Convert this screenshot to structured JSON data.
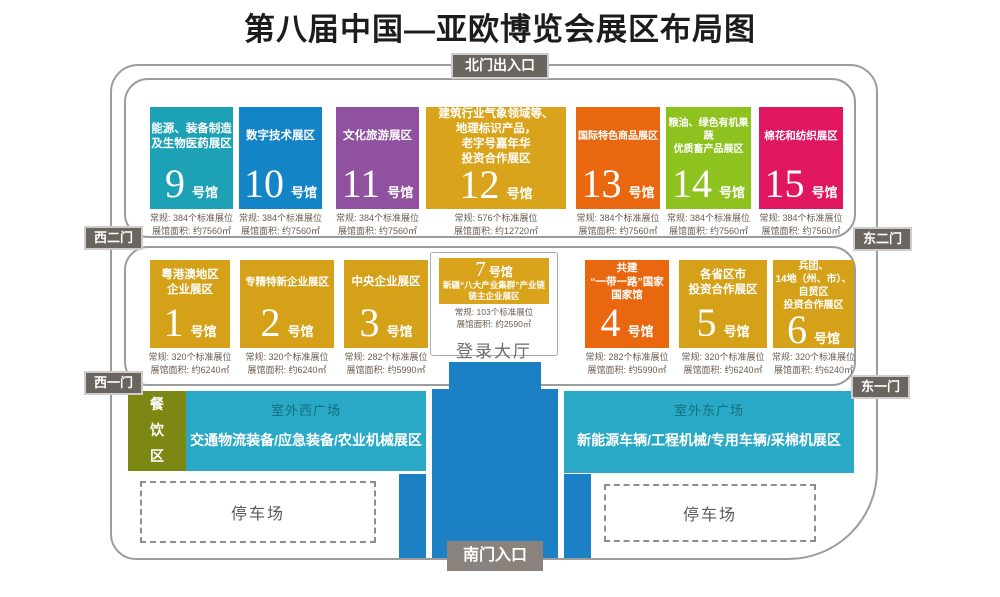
{
  "title": "第八届中国—亚欧博览会展区布局图",
  "gates": {
    "north": "北门出入口",
    "south": "南门入口",
    "west2": "西二门",
    "west1": "西一门",
    "east2": "东二门",
    "east1": "东一门"
  },
  "labels": {
    "hall_suffix": "号馆",
    "login_hall": "登录大厅",
    "dining": "餐饮区",
    "parking": "停车场"
  },
  "halls_row1": [
    {
      "number": "9",
      "name": "能源、装备制造\n及生物医药展区",
      "booths": "常规: 384个标准展位",
      "area": "展馆面积: 约7560㎡",
      "color": "#1ca1b6"
    },
    {
      "number": "10",
      "name": "数字技术展区",
      "booths": "常规: 384个标准展位",
      "area": "展馆面积: 约7560㎡",
      "color": "#1385c6"
    },
    {
      "number": "11",
      "name": "文化旅游展区",
      "booths": "常规: 384个标准展位",
      "area": "展馆面积: 约7560㎡",
      "color": "#9051a0"
    },
    {
      "number": "12",
      "name": "建筑行业气象领域等、\n地理标识产品，\n老字号嘉年华\n投资合作展区",
      "booths": "常规: 576个标准展位",
      "area": "展馆面积: 约12720㎡",
      "color": "#d9a41c"
    },
    {
      "number": "13",
      "name": "国际特色商品展区",
      "booths": "常规: 384个标准展位",
      "area": "展馆面积: 约7560㎡",
      "color": "#e9680f"
    },
    {
      "number": "14",
      "name": "粮油、绿色有机果蔬\n优质畜产品展区",
      "booths": "常规: 384个标准展位",
      "area": "展馆面积: 约7560㎡",
      "color": "#8dc21f"
    },
    {
      "number": "15",
      "name": "棉花和纺织展区",
      "booths": "常规: 384个标准展位",
      "area": "展馆面积: 约7560㎡",
      "color": "#e0175f"
    }
  ],
  "halls_row2": [
    {
      "number": "1",
      "name": "粤港澳地区\n企业展区",
      "booths": "常规: 320个标准展位",
      "area": "展馆面积: 约6240㎡",
      "color": "#d4a119"
    },
    {
      "number": "2",
      "name": "专精特新企业展区",
      "booths": "常规: 320个标准展位",
      "area": "展馆面积: 约6240㎡",
      "color": "#d4a119"
    },
    {
      "number": "3",
      "name": "中央企业展区",
      "booths": "常规: 282个标准展位",
      "area": "展馆面积: 约5990㎡",
      "color": "#d4a119"
    },
    {
      "number": "4",
      "name": "共建\n“一带一路”国家\n国家馆",
      "booths": "常规: 282个标准展位",
      "area": "展馆面积: 约5990㎡",
      "color": "#e9680f"
    },
    {
      "number": "5",
      "name": "各省区市\n投资合作展区",
      "booths": "常规: 320个标准展位",
      "area": "展馆面积: 约6240㎡",
      "color": "#d4a119"
    },
    {
      "number": "6",
      "name": "兵团、\n14地（州、市）、\n自贸区\n投资合作展区",
      "booths": "常规: 320个标准展位",
      "area": "展馆面积: 约6240㎡",
      "color": "#d4a119"
    }
  ],
  "hall7": {
    "number": "7",
    "name": "新疆“八大产业集群”产业链\n链主企业展区",
    "booths": "常规: 103个标准展位",
    "area": "展馆面积: 约2590㎡",
    "color": "#d9a41c"
  },
  "plazas": {
    "west": {
      "title": "室外西广场",
      "zone": "交通物流装备/应急装备/农业机械展区"
    },
    "east": {
      "title": "室外东广场",
      "zone": "新能源车辆/工程机械/专用车辆/采棉机展区"
    }
  },
  "colors": {
    "gate_badge": "#6b6560",
    "south_badge": "#8a837d",
    "dining": "#7c8714",
    "plaza": "#29a9c5",
    "entrance_blue": "#1b80c4",
    "border_gray": "#9c9c9c",
    "stats_text": "#6b5b4f"
  }
}
